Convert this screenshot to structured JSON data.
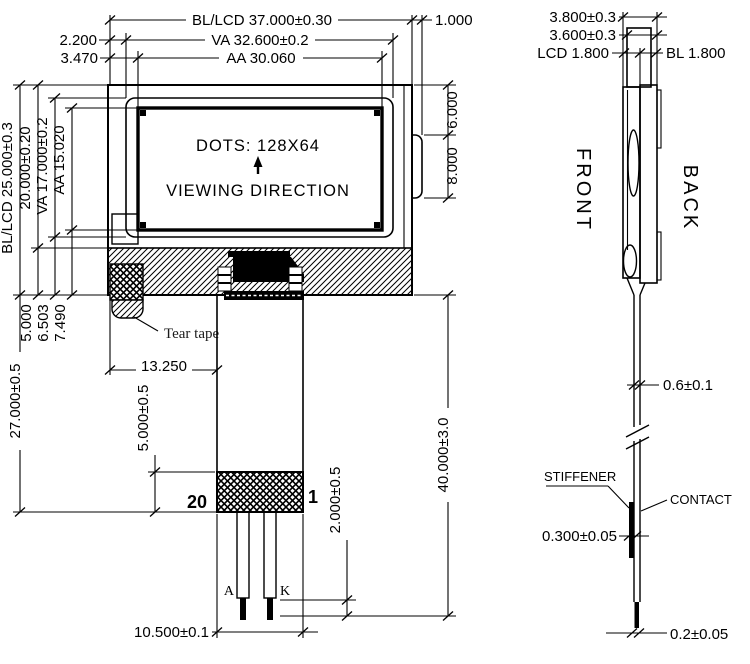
{
  "front_view": {
    "dim_top_width_bl_lcd": "BL/LCD 37.000±0.30",
    "dim_top_width_va": "VA 32.600±0.2",
    "dim_top_width_aa": "AA 30.060",
    "dim_top_right_offset": "1.000",
    "dim_top_left_offset_va": "2.200",
    "dim_top_left_offset_aa": "3.470",
    "dim_left_height_bl_lcd": "BL/LCD 25.000±0.3",
    "dim_left_height_lcd": "20.000±0.20",
    "dim_left_height_va": "VA 17.000±0.2",
    "dim_left_height_aa": "AA 15.020",
    "dim_right_tab_offset": "6.000",
    "dim_right_tab_height": "8.000",
    "display_dots": "DOTS: 128X64",
    "display_viewing_direction": "VIEWING DIRECTION",
    "tear_tape_label": "Tear tape",
    "dim_bottom_offset_1": "5.000",
    "dim_bottom_offset_2": "6.503",
    "dim_bottom_offset_3": "7.490",
    "dim_tail_offset_x": "13.250",
    "dim_module_to_connector_end": "27.000±0.5",
    "dim_connector_height": "5.000±0.5",
    "pin20_label": "20",
    "pin1_label": "1",
    "pin_anode_label": "A",
    "pin_cathode_label": "K",
    "dim_pin_tip_length": "2.000±0.5",
    "dim_tail_width": "10.500±0.1",
    "dim_tail_length": "40.000±3.0"
  },
  "side_view": {
    "dim_thickness_total": "3.800±0.3",
    "dim_thickness_inner": "3.600±0.3",
    "dim_thickness_lcd": "LCD 1.800",
    "dim_thickness_bl": "BL 1.800",
    "front_label": "FRONT",
    "back_label": "BACK",
    "dim_fpc_thickness": "0.6±0.1",
    "stiffener_label": "STIFFENER",
    "contact_label": "CONTACT",
    "dim_stiffener_thickness": "0.300±0.05",
    "dim_tip_thickness": "0.2±0.05"
  }
}
